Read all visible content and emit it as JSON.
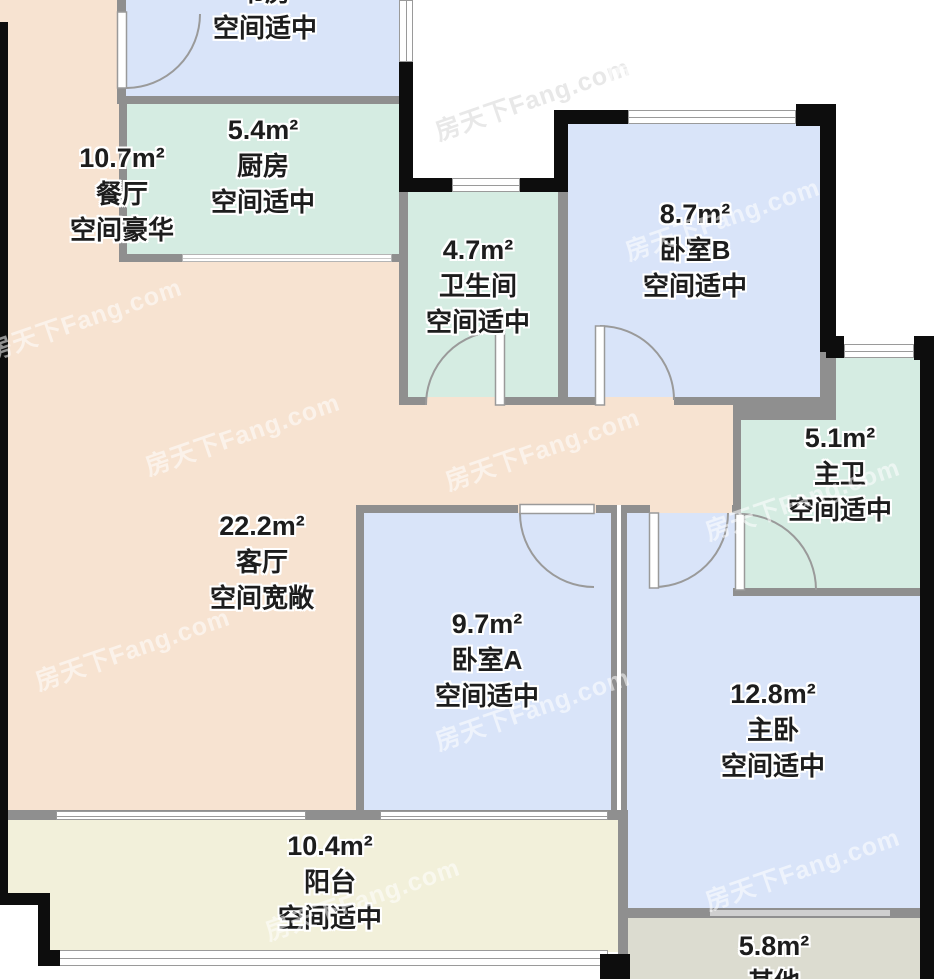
{
  "watermark": {
    "text": "房天下Fang.com"
  },
  "palette": {
    "living_dining_floor": "#f7e3d1",
    "bedroom_floor": "#d9e4f9",
    "kitchen_bath_floor": "#d5ece2",
    "balcony_floor": "#f2f0da",
    "other_floor": "#dcdcd0",
    "wall_gray": "#8f8f8f",
    "wall_black": "#0d0d0d"
  },
  "rooms": [
    {
      "id": "study",
      "area": "",
      "name": "书房",
      "desc": "空间适中"
    },
    {
      "id": "dining",
      "area": "10.7m²",
      "name": "餐厅",
      "desc": "空间豪华"
    },
    {
      "id": "kitchen",
      "area": "5.4m²",
      "name": "厨房",
      "desc": "空间适中"
    },
    {
      "id": "bathroom",
      "area": "4.7m²",
      "name": "卫生间",
      "desc": "空间适中"
    },
    {
      "id": "bedroom-b",
      "area": "8.7m²",
      "name": "卧室B",
      "desc": "空间适中"
    },
    {
      "id": "master-bath",
      "area": "5.1m²",
      "name": "主卫",
      "desc": "空间适中"
    },
    {
      "id": "living",
      "area": "22.2m²",
      "name": "客厅",
      "desc": "空间宽敞"
    },
    {
      "id": "bedroom-a",
      "area": "9.7m²",
      "name": "卧室A",
      "desc": "空间适中"
    },
    {
      "id": "master-bedroom",
      "area": "12.8m²",
      "name": "主卧",
      "desc": "空间适中"
    },
    {
      "id": "balcony",
      "area": "10.4m²",
      "name": "阳台",
      "desc": "空间适中"
    },
    {
      "id": "other",
      "area": "5.8m²",
      "name": "其他",
      "desc": ""
    }
  ]
}
